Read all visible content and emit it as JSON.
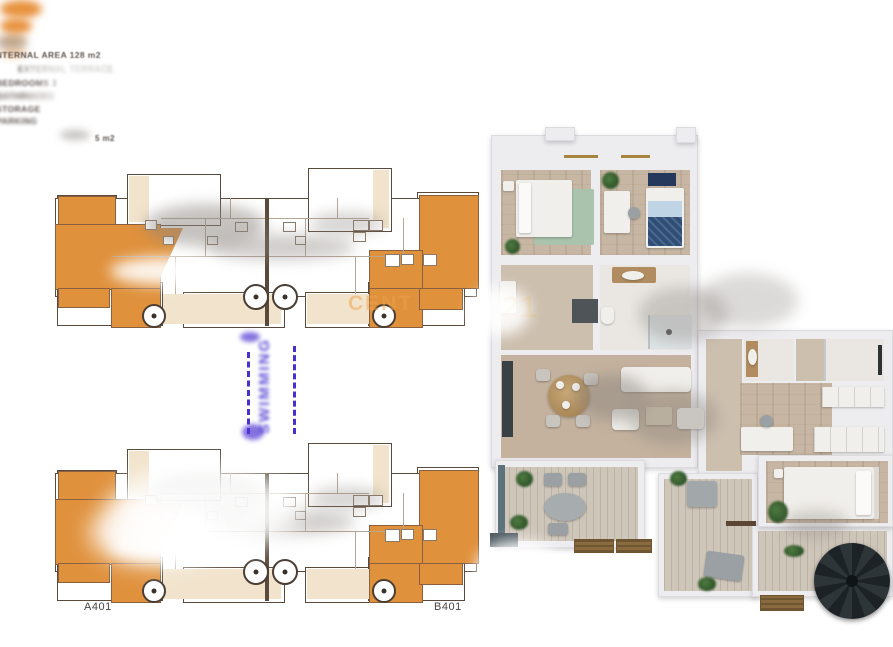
{
  "specs": {
    "lines": [
      "INTERNAL AREA 128 m2",
      "EXTERNAL TERRACE",
      "BEDROOMS 3",
      "BATHROOMS",
      "STORAGE",
      "PARKING"
    ],
    "footnote": "5 m2"
  },
  "plan_labels": {
    "a": "A401",
    "b": "B401"
  },
  "pool": {
    "label": "SWIMMING"
  },
  "watermarks": {
    "plans": "CENT",
    "render": "21"
  },
  "colors": {
    "plan_orange": "#E0913C",
    "plan_cream": "#F2E4CC",
    "plan_wall": "#5A4A3C",
    "pool_purple": "#4A2FD0",
    "wall_white": "#EDECEF",
    "wood_floor": "#C7B6A3",
    "rug_green": "#A9C3AC",
    "bed_navy": "#2E4E78",
    "stair_dark": "#22282B",
    "doormat_brown": "#8A6B3F",
    "watermark_gold": "#D9B05C",
    "watermark_orange": "#EBA24A"
  }
}
